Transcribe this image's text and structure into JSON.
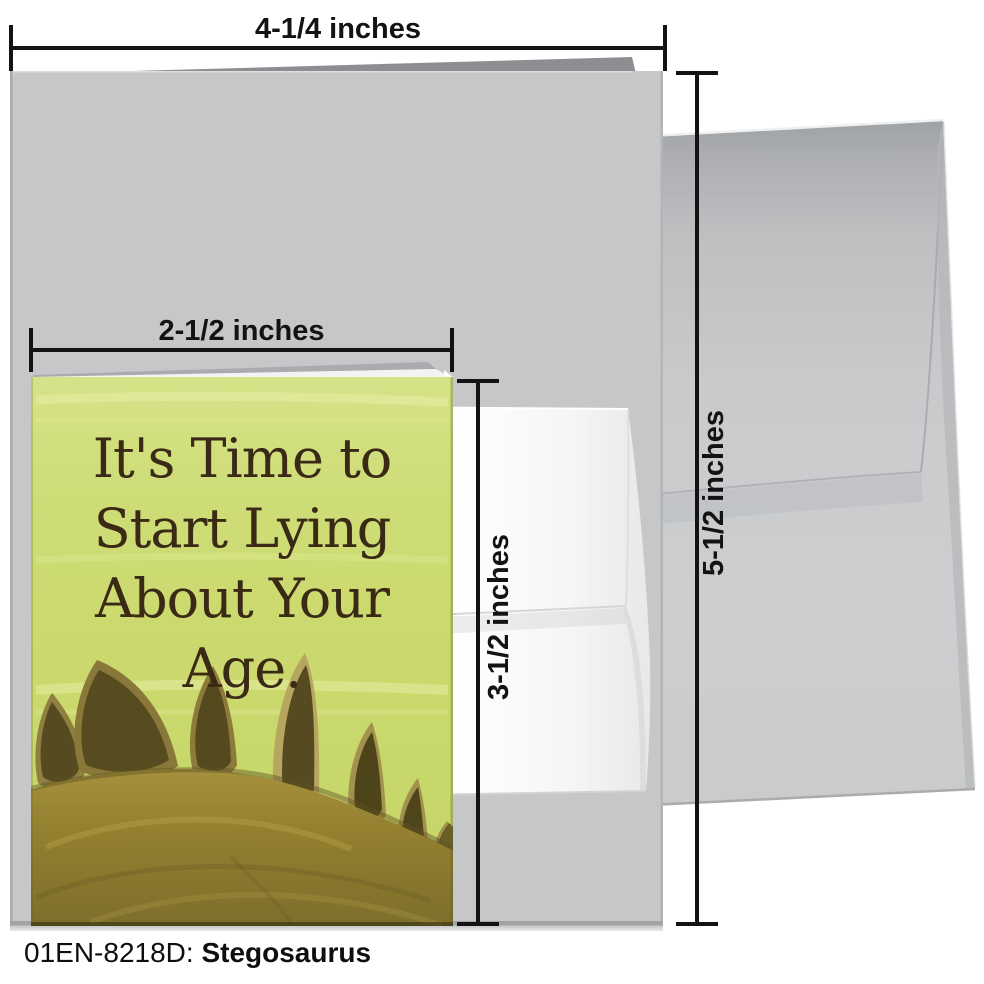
{
  "caption": {
    "code": "01EN-8218D:",
    "name": "Stegosaurus"
  },
  "dimension_labels": {
    "large_card_width": "4-1/4 inches",
    "large_card_height": "5-1/2 inches",
    "small_card_width": "2-1/2 inches",
    "small_card_height": "3-1/2 inches"
  },
  "small_card_front_text": {
    "line1": "It's Time to",
    "line2": "Start Lying",
    "line3": "About Your Age."
  },
  "colors": {
    "small_card_green": "#cbd96e",
    "card_text_brown": "#3a2a15",
    "large_card_gray": "#c6c7c9",
    "large_envelope_gray": "#c9cbcd",
    "small_envelope_white": "#fbfbfc",
    "dimension_line": "#131313"
  }
}
